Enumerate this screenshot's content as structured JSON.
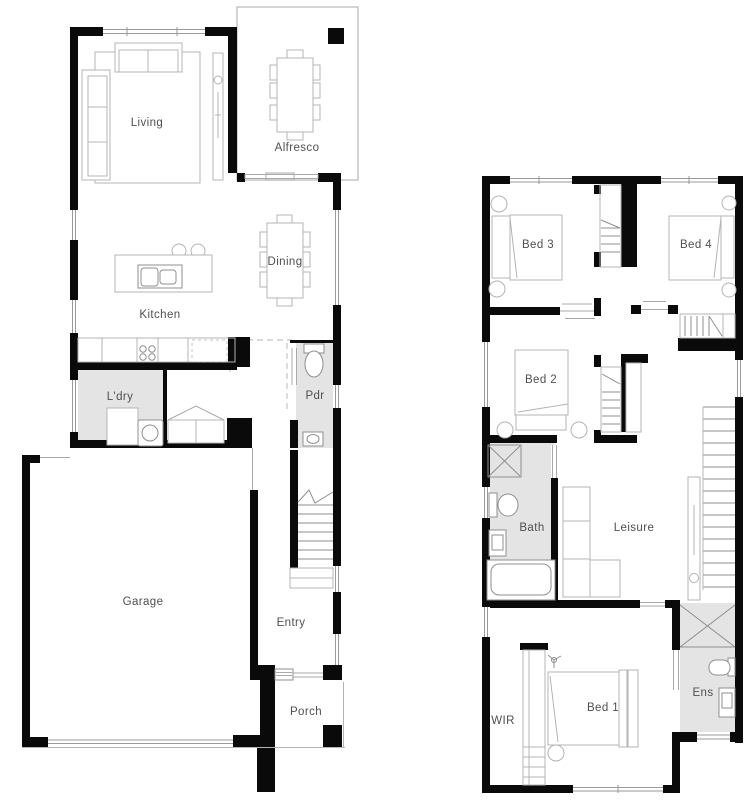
{
  "palette": {
    "background": "#ffffff",
    "wall": "#0a0a0a",
    "wet_area": "#e4e4e4",
    "furniture_line": "#b4b4b4",
    "fixture_line": "#8f8f8f",
    "window_line": "#9a9a9a",
    "dash_line": "#c4c4c4",
    "label_color": "#4f4f4f"
  },
  "floors": [
    {
      "id": "ground-floor",
      "rooms": [
        {
          "id": "living",
          "label": "Living",
          "cx": 147,
          "cy": 123
        },
        {
          "id": "alfresco",
          "label": "Alfresco",
          "cx": 297,
          "cy": 148
        },
        {
          "id": "dining",
          "label": "Dining",
          "cx": 285,
          "cy": 262
        },
        {
          "id": "kitchen",
          "label": "Kitchen",
          "cx": 160,
          "cy": 315
        },
        {
          "id": "laundry",
          "label": "L'dry",
          "cx": 120,
          "cy": 397
        },
        {
          "id": "powder",
          "label": "Pdr",
          "cx": 315,
          "cy": 396
        },
        {
          "id": "garage",
          "label": "Garage",
          "cx": 143,
          "cy": 602
        },
        {
          "id": "entry",
          "label": "Entry",
          "cx": 291,
          "cy": 623
        },
        {
          "id": "porch",
          "label": "Porch",
          "cx": 306,
          "cy": 712
        }
      ]
    },
    {
      "id": "upper-floor",
      "rooms": [
        {
          "id": "bed3",
          "label": "Bed 3",
          "cx": 538,
          "cy": 245
        },
        {
          "id": "bed4",
          "label": "Bed 4",
          "cx": 696,
          "cy": 245
        },
        {
          "id": "bed2",
          "label": "Bed 2",
          "cx": 541,
          "cy": 380
        },
        {
          "id": "bath",
          "label": "Bath",
          "cx": 532,
          "cy": 528
        },
        {
          "id": "leisure",
          "label": "Leisure",
          "cx": 634,
          "cy": 528
        },
        {
          "id": "wir",
          "label": "WIR",
          "cx": 503,
          "cy": 721
        },
        {
          "id": "bed1",
          "label": "Bed 1",
          "cx": 603,
          "cy": 708
        },
        {
          "id": "ens",
          "label": "Ens",
          "cx": 703,
          "cy": 693
        }
      ]
    }
  ]
}
